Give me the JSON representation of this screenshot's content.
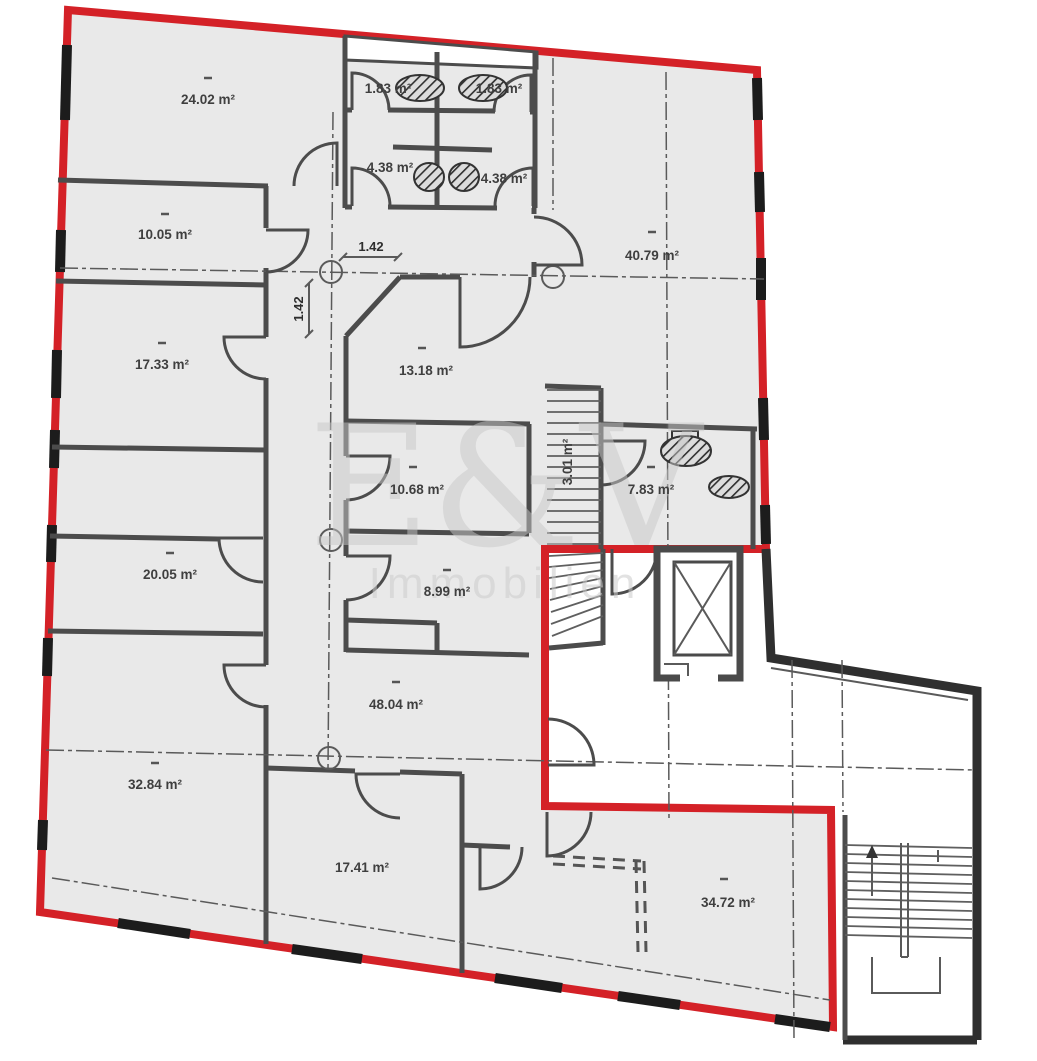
{
  "plan": {
    "type": "floor-plan",
    "unit_outline_color": "#d42127",
    "wall_color": "#4c4c4c",
    "floor_color": "#e9e9e9",
    "label_color": "#3f3f3f"
  },
  "watermark": {
    "monogram": "E&V",
    "subtitle": "Immobilien"
  },
  "rooms": [
    {
      "name": "room-24-02",
      "area_label": "24.02 m²",
      "area_m2": 24.02
    },
    {
      "name": "room-10-05",
      "area_label": "10.05 m²",
      "area_m2": 10.05
    },
    {
      "name": "room-17-33",
      "area_label": "17.33 m²",
      "area_m2": 17.33
    },
    {
      "name": "room-20-05",
      "area_label": "20.05 m²",
      "area_m2": 20.05
    },
    {
      "name": "room-32-84",
      "area_label": "32.84 m²",
      "area_m2": 32.84
    },
    {
      "name": "wc-1-83-left",
      "area_label": "1.83 m²",
      "area_m2": 1.83
    },
    {
      "name": "wc-1-83-right",
      "area_label": "1.83 m²",
      "area_m2": 1.83
    },
    {
      "name": "wc-4-38-left",
      "area_label": "4.38 m²",
      "area_m2": 4.38
    },
    {
      "name": "wc-4-38-right",
      "area_label": "4.38 m²",
      "area_m2": 4.38
    },
    {
      "name": "room-40-79",
      "area_label": "40.79 m²",
      "area_m2": 40.79
    },
    {
      "name": "room-13-18",
      "area_label": "13.18 m²",
      "area_m2": 13.18
    },
    {
      "name": "room-10-68",
      "area_label": "10.68 m²",
      "area_m2": 10.68
    },
    {
      "name": "room-8-99",
      "area_label": "8.99 m²",
      "area_m2": 8.99
    },
    {
      "name": "room-48-04",
      "area_label": "48.04 m²",
      "area_m2": 48.04
    },
    {
      "name": "room-17-41",
      "area_label": "17.41 m²",
      "area_m2": 17.41
    },
    {
      "name": "room-34-72",
      "area_label": "34.72 m²",
      "area_m2": 34.72
    },
    {
      "name": "bath-7-83",
      "area_label": "7.83 m²",
      "area_m2": 7.83
    },
    {
      "name": "stair-3-01",
      "area_label": "3.01 m²",
      "area_m2": 3.01
    }
  ],
  "dimensions": [
    {
      "name": "dim-horizontal",
      "label": "1.42",
      "orientation": "horizontal"
    },
    {
      "name": "dim-vertical",
      "label": "1.42",
      "orientation": "vertical"
    }
  ]
}
